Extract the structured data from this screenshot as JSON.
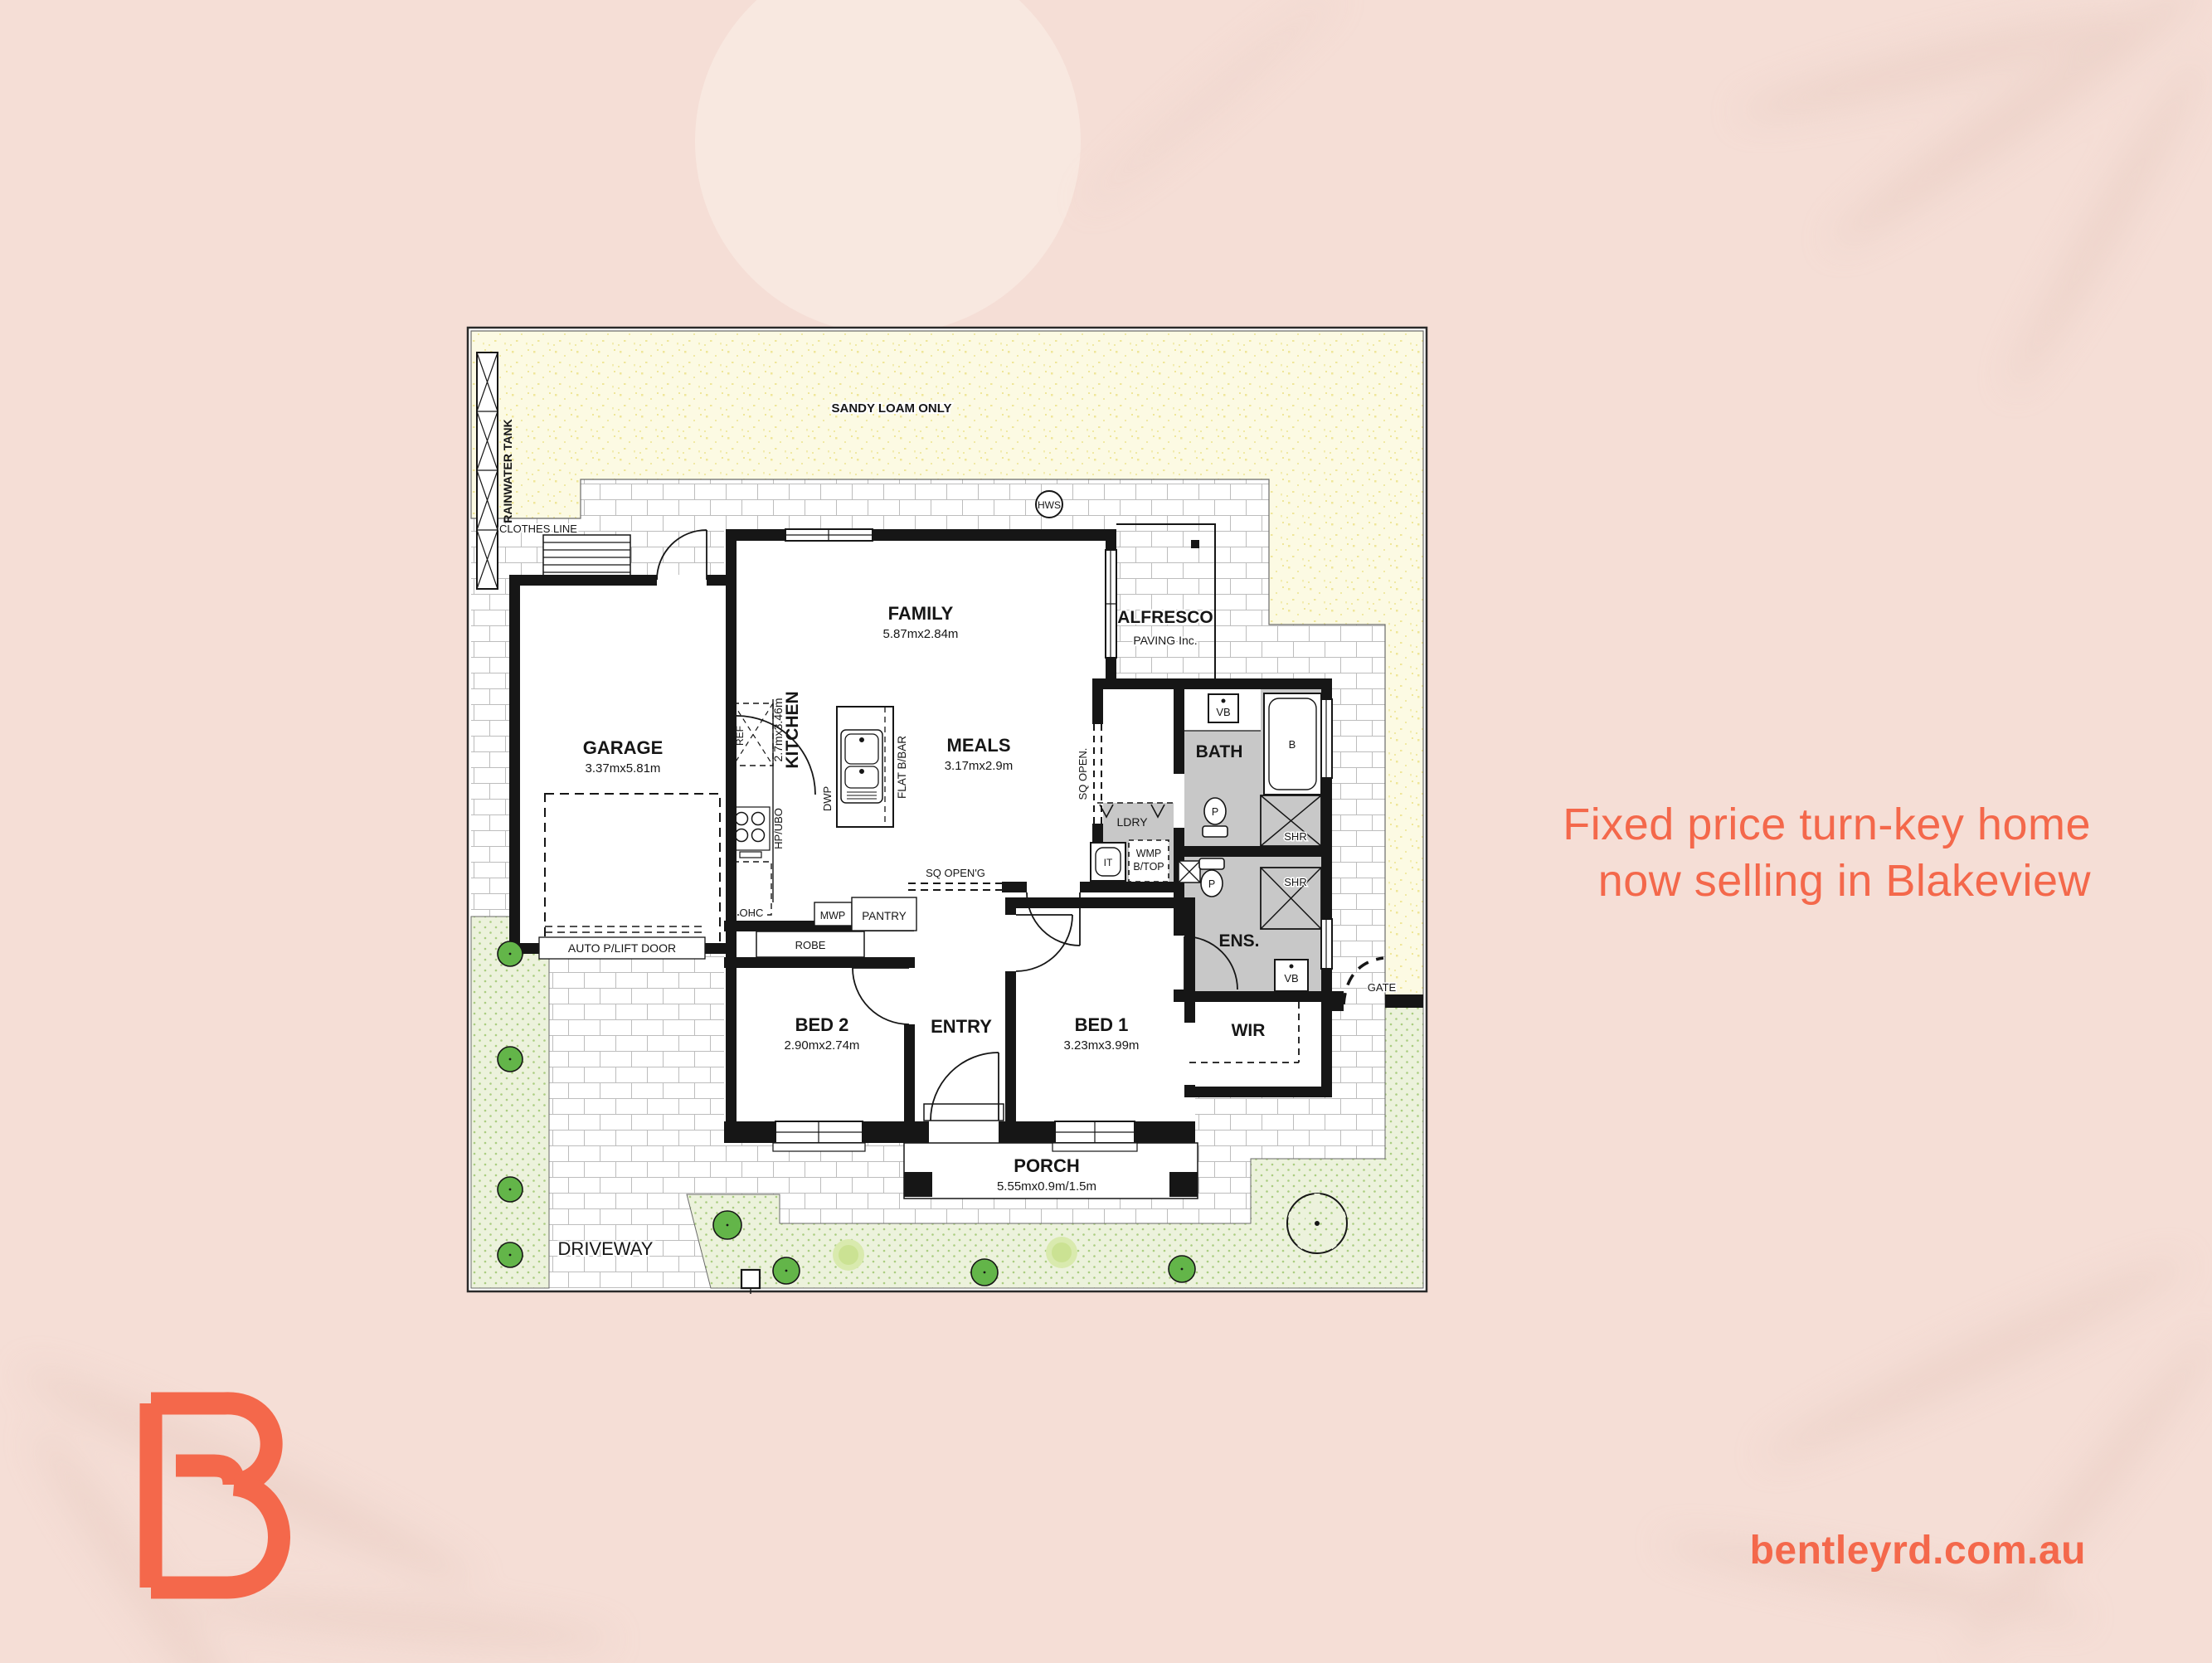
{
  "colors": {
    "background": "#F5DED6",
    "accent": "#F4684B",
    "deco_circle": "#F8E8E0",
    "sand_area": "#FCFAE3",
    "garden_area": "#ECF2DC",
    "shrub_green": "#63B549",
    "wet_area_floor": "#C8C8C8"
  },
  "headline": {
    "line1": "Fixed price turn-key home",
    "line2": "now selling in Blakeview"
  },
  "footer": {
    "website": "bentleyrd.com.au"
  },
  "plan": {
    "labels": {
      "rainwater_tank": "RAINWATER TANK",
      "sandy_loam": "SANDY LOAM ONLY",
      "clothes_line": "CLOTHES LINE",
      "hws": "HWS",
      "garage": "GARAGE",
      "garage_dims": "3.37mx5.81m",
      "auto_door": "AUTO P/LIFT DOOR",
      "family": "FAMILY",
      "family_dims": "5.87mx2.84m",
      "alfresco": "ALFRESCO",
      "alfresco_note": "PAVING Inc.",
      "kitchen": "KITCHEN",
      "kitchen_dims": "2.7mx3.46m",
      "ref": "REF",
      "hp_ubo": "HP/UBO",
      "dwp": "DWP",
      "flat_bbar": "FLAT B/BAR",
      "ohc": "OHC",
      "mwp": "MWP",
      "pantry": "PANTRY",
      "sq_opening": "SQ OPEN'G",
      "sq_open": "SQ OPEN.",
      "meals": "MEALS",
      "meals_dims": "3.17mx2.9m",
      "ldry": "LDRY",
      "it": "IT",
      "wmp_line1": "WMP",
      "wmp_line2": "B/TOP",
      "bath": "BATH",
      "vb": "VB",
      "bathtub": "B",
      "pan": "P",
      "shr": "SHR",
      "ens": "ENS.",
      "wir": "WIR",
      "gate": "GATE",
      "bed1": "BED 1",
      "bed1_dims": "3.23mx3.99m",
      "bed2": "BED 2",
      "bed2_dims": "2.90mx2.74m",
      "entry": "ENTRY",
      "robe": "ROBE",
      "porch": "PORCH",
      "porch_dims": "5.55mx0.9m/1.5m",
      "driveway": "DRIVEWAY",
      "letter_box": "LETTER BOX"
    }
  }
}
